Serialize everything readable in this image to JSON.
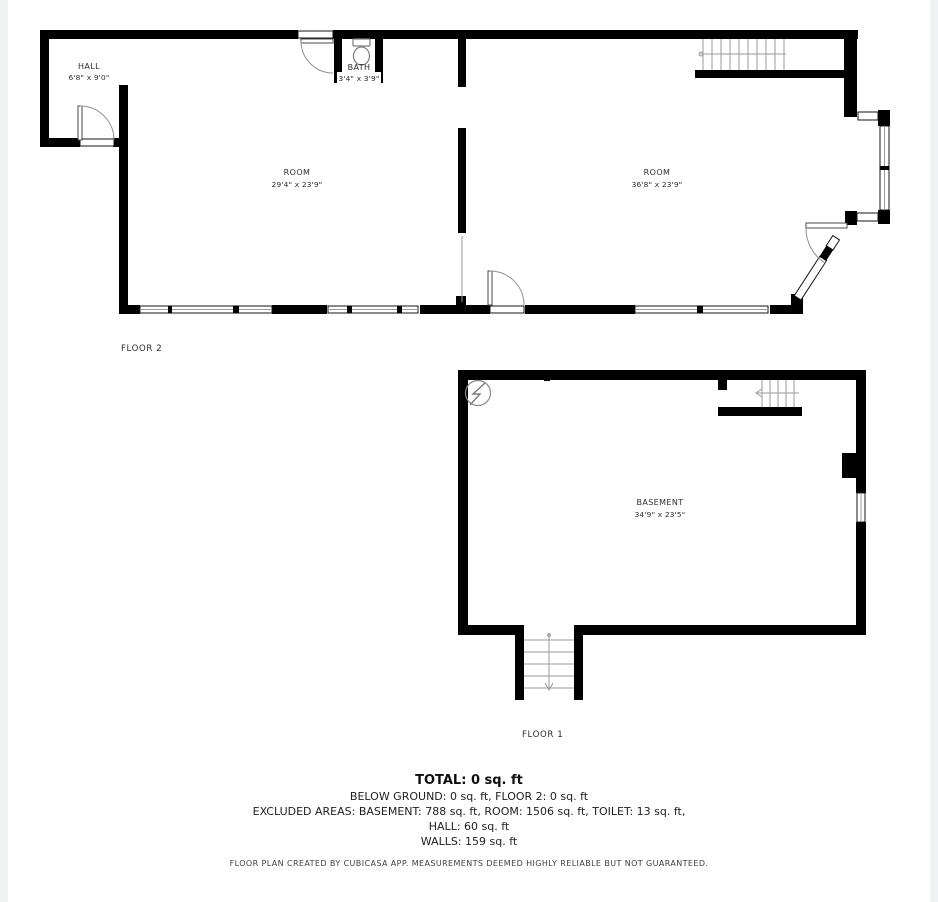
{
  "floor2": {
    "label": "FLOOR 2",
    "hall": {
      "name": "HALL",
      "dims": "6'8\" x 9'0\""
    },
    "bath": {
      "name": "BATH",
      "dims": "3'4\" x 3'9\""
    },
    "room_left": {
      "name": "ROOM",
      "dims": "29'4\" x 23'9\""
    },
    "room_right": {
      "name": "ROOM",
      "dims": "36'8\" x 23'9\""
    }
  },
  "floor1": {
    "label": "FLOOR 1",
    "basement": {
      "name": "BASEMENT",
      "dims": "34'9\" x 23'5\""
    }
  },
  "summary": {
    "total": "TOTAL: 0 sq. ft",
    "line2": "BELOW GROUND: 0 sq. ft, FLOOR 2: 0 sq. ft",
    "line3": "EXCLUDED AREAS: BASEMENT: 788 sq. ft, ROOM: 1506 sq. ft, TOILET: 13 sq. ft,",
    "line4": "HALL: 60 sq. ft",
    "line5": "WALLS: 159 sq. ft",
    "disclaimer": "FLOOR PLAN CREATED BY CUBICASA APP. MEASUREMENTS DEEMED HIGHLY RELIABLE BUT NOT GUARANTEED."
  },
  "colors": {
    "wall": "#000000",
    "thin_line": "#9a9a9a",
    "text": "#2c2c2c",
    "background": "#ffffff"
  }
}
